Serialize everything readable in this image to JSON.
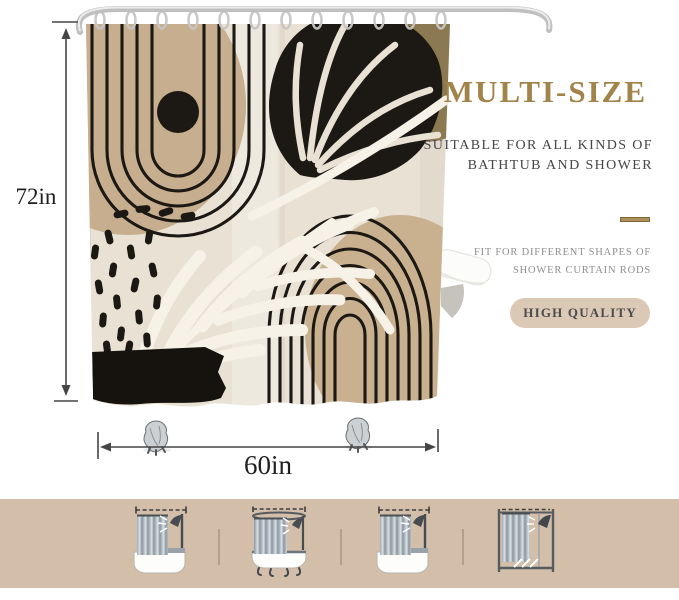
{
  "dimensions": {
    "height": "72in",
    "width": "60in"
  },
  "marketing": {
    "headline": "MULTI-SIZE",
    "subheadline_line1": "SUITABLE FOR ALL KINDS OF",
    "subheadline_line2": "BATHTUB AND SHOWER",
    "feature_line1": "FIT FOR DIFFERENT SHAPES OF",
    "feature_line2": "SHOWER CURTAIN RODS",
    "badge_label": "HIGH QUALITY"
  },
  "palette": {
    "headline-color": "#a28349",
    "badge-bg": "#dbc8b5",
    "badge-text": "#4c4c4c",
    "strip-bg": "#d3bfa9",
    "divider-gold": "#ac9057",
    "curtain-cream": "#e9e2d4",
    "curtain-tan": "#c7ae8e",
    "curtain-olive": "#8b7951",
    "curtain-black": "#1c1814",
    "leaf-white": "#f6f2e8"
  },
  "size_variants": {
    "items": [
      {
        "icon": "straight-rod-over-bathtub"
      },
      {
        "icon": "curved-rod-over-clawfoot-tub"
      },
      {
        "icon": "straight-rod-over-bathtub"
      },
      {
        "icon": "walk-in-shower-stall"
      }
    ]
  }
}
